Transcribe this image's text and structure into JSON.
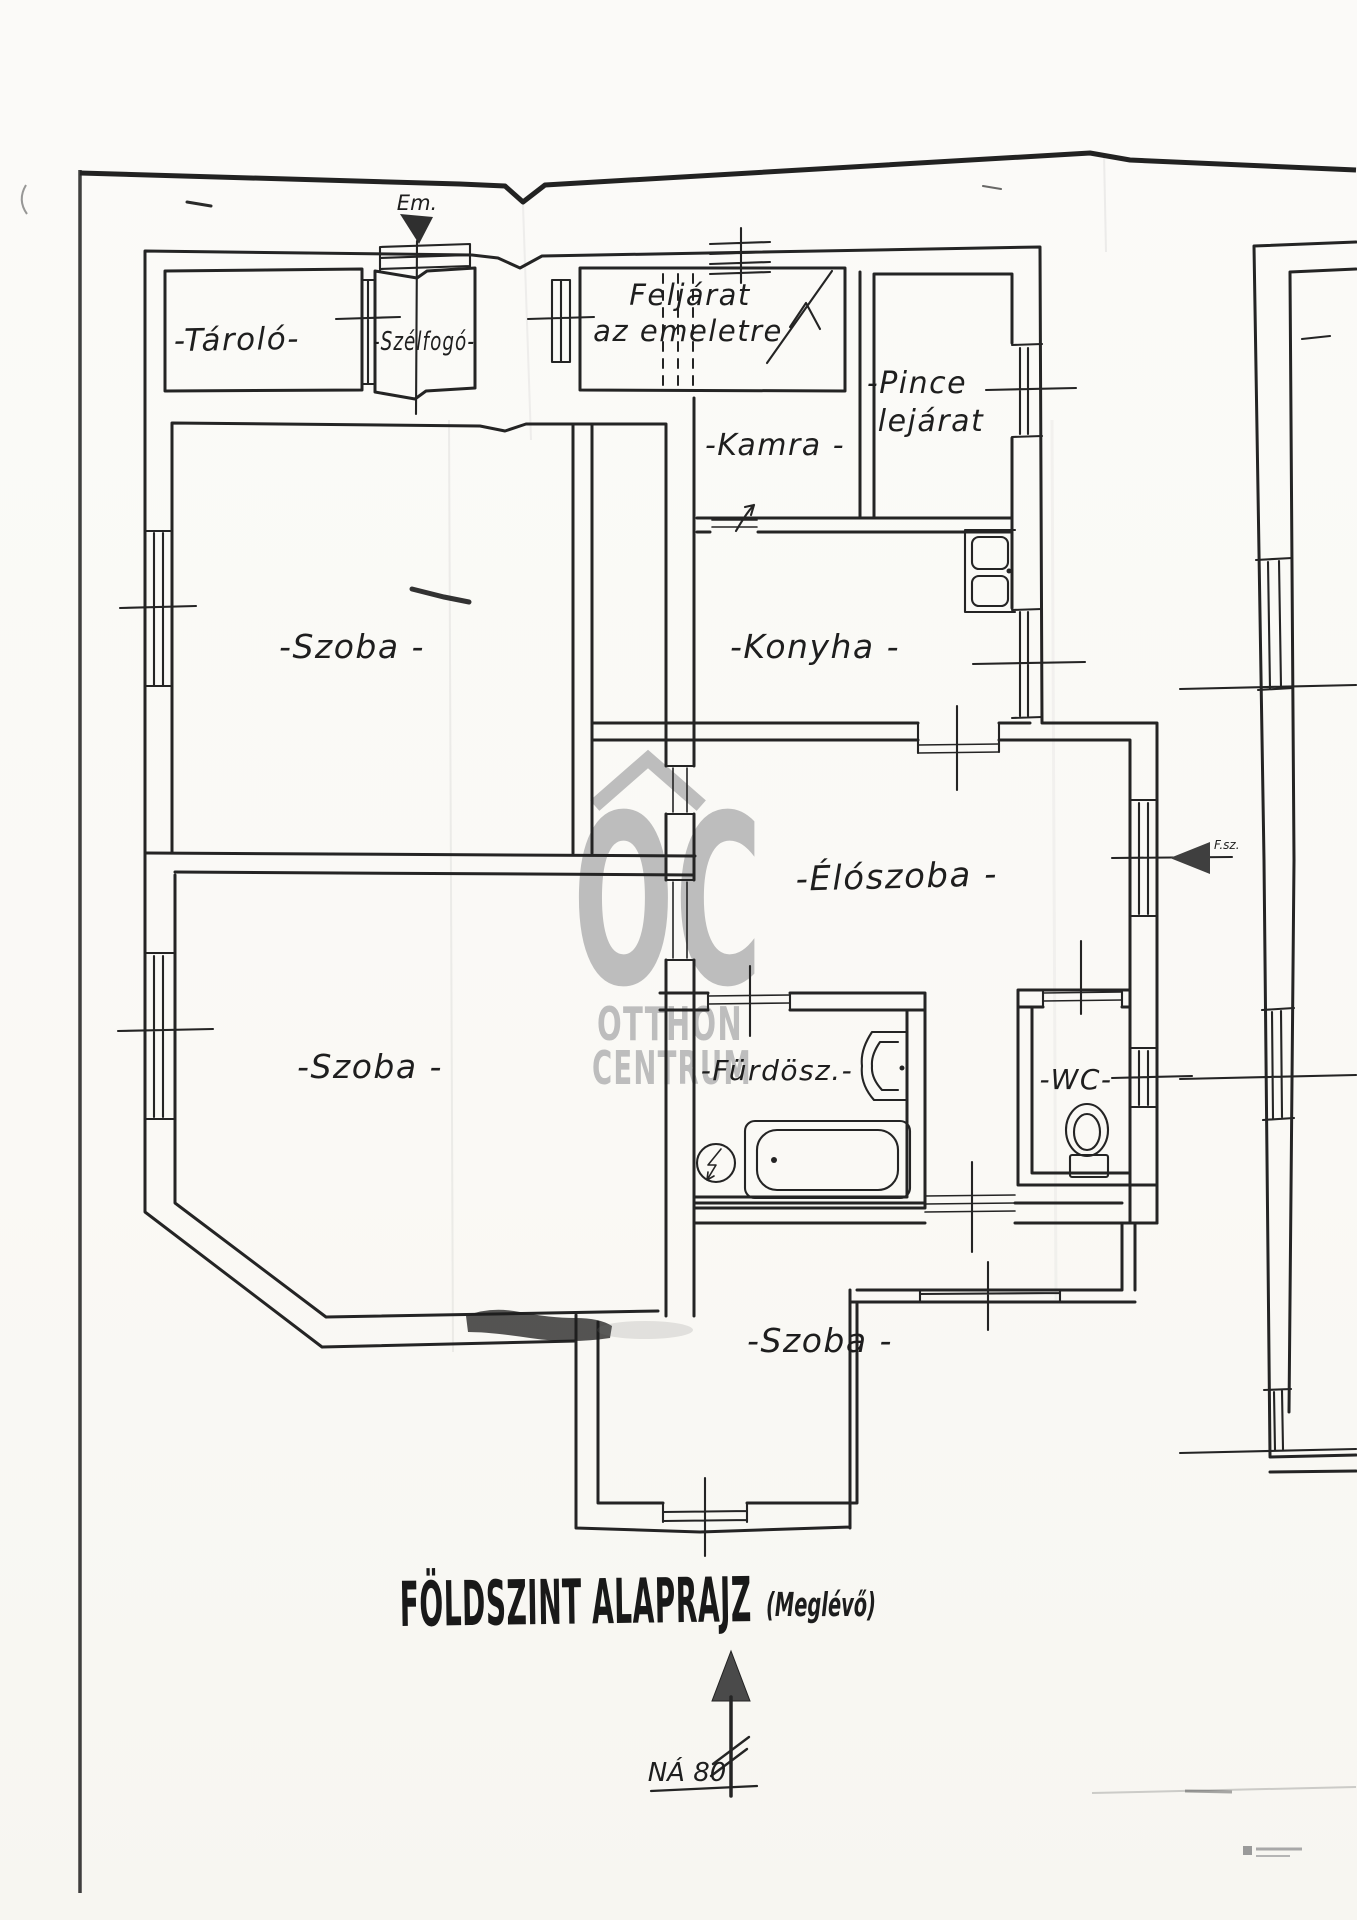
{
  "colors": {
    "ink": "#242424",
    "paper": "#fbfaf8",
    "watermark": "#bdbdbd",
    "arrow_fill": "#3f3f3f"
  },
  "watermark": {
    "monogram": "OC",
    "line1": "OTTHON",
    "line2": "CENTRUM"
  },
  "plan": {
    "rooms": {
      "tarolo": "-Tároló-",
      "szelfogo": "-Szélfogó-",
      "feljarat_line1": "Feljárat",
      "feljarat_line2": "az emeletre",
      "kamra": "-Kamra -",
      "pince_line1": "-Pince",
      "pince_line2": "lejárat",
      "szoba_top": "-Szoba -",
      "konyha": "-Konyha -",
      "eloszoba": "-Élószoba -",
      "szoba_left": "-Szoba -",
      "furdoszoba": "-Fürdösz.-",
      "wc": "-WC-",
      "szoba_bottom": "-Szoba -"
    },
    "markers": {
      "upstairs": "Em.",
      "ground": "F.sz."
    },
    "title": {
      "main": "FÖLDSZINT ALAPRAJZ",
      "suffix": "(Meglévő)"
    },
    "north": {
      "label": "NÁ 80"
    }
  }
}
